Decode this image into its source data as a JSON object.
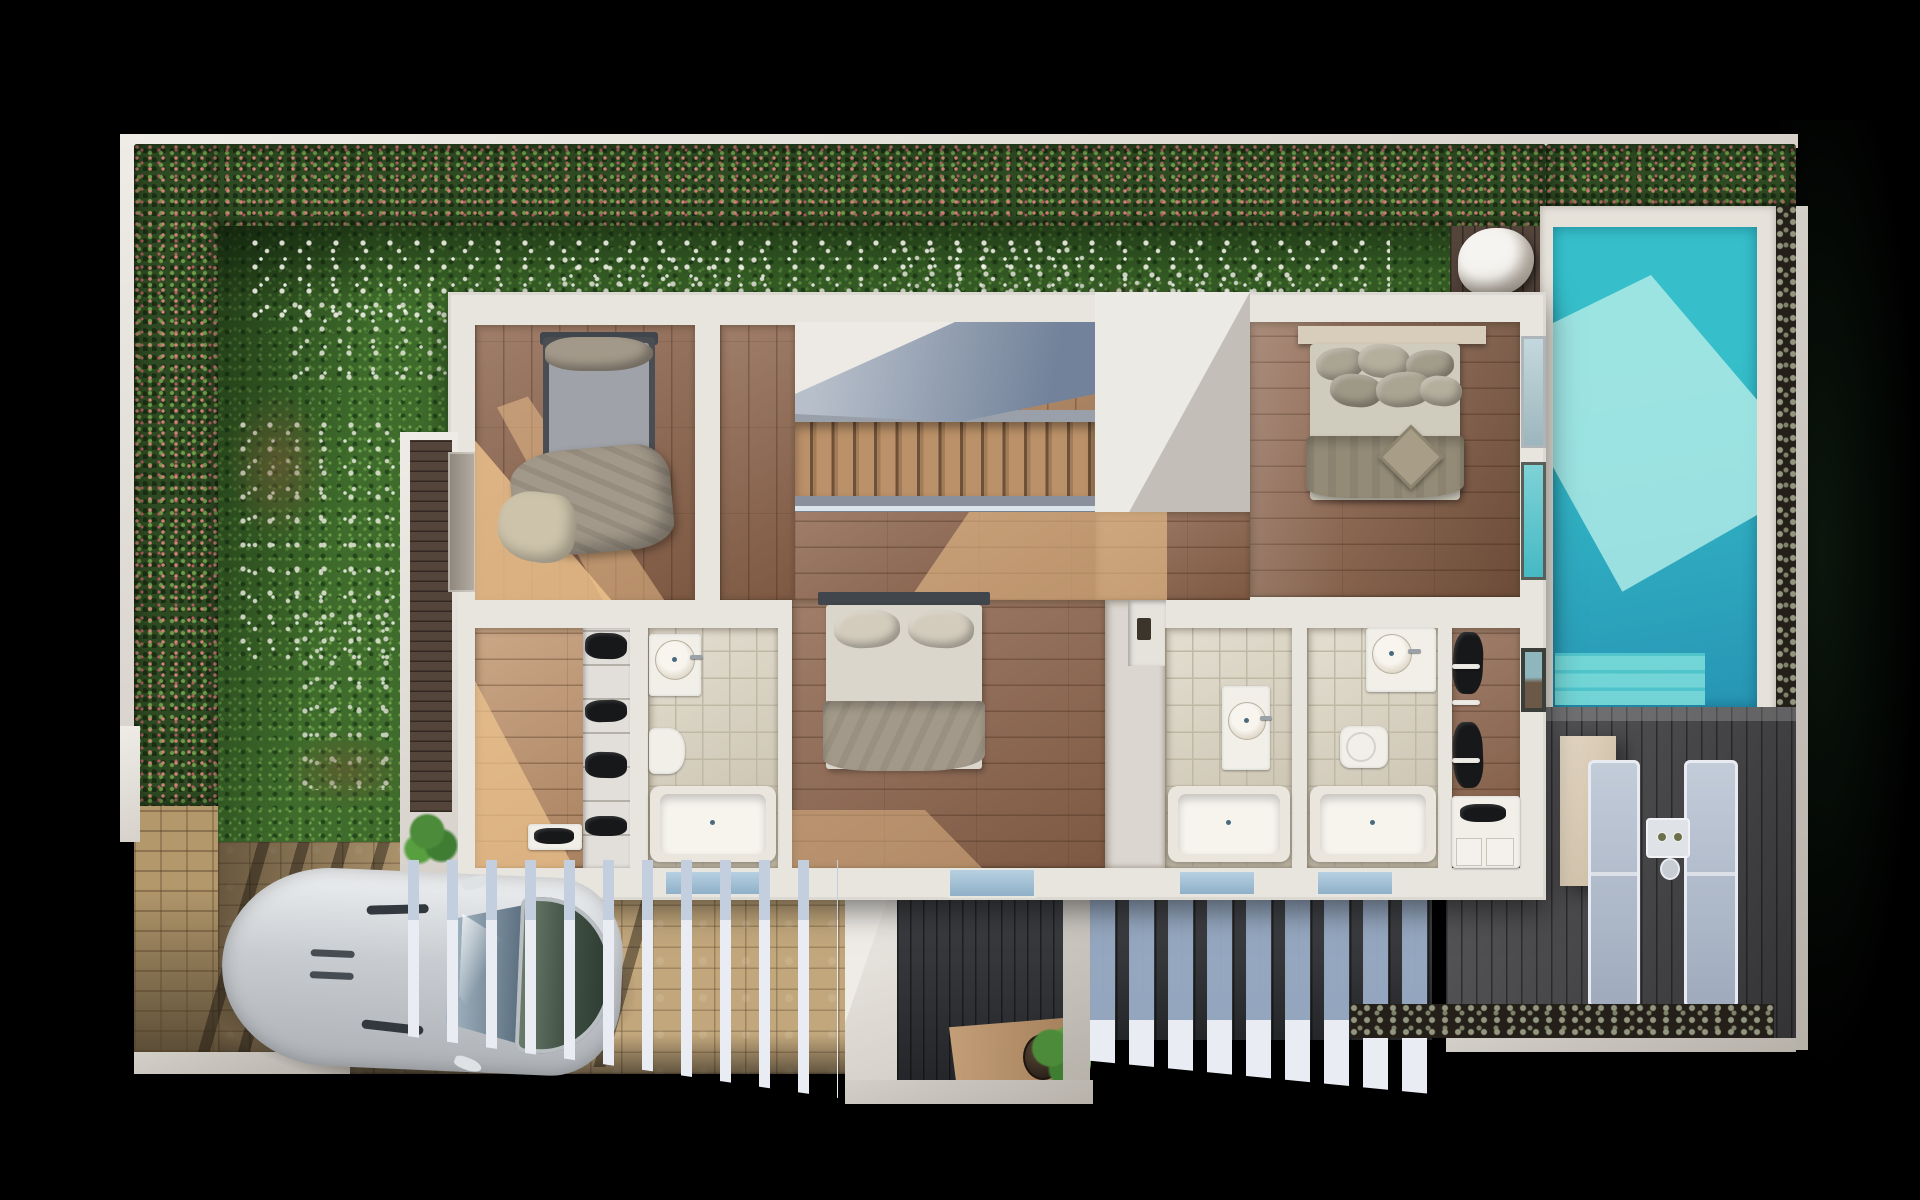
{
  "scene": {
    "title": "Top-down 3D render of a villa upper-floor plan",
    "view": "top-down axonometric cutaway",
    "rooms": [
      {
        "name": "bedroom-front",
        "label": "Front bedroom",
        "furniture": [
          "dark-frame bed with gray mattress",
          "taupe throw blankets",
          "door to side balcony"
        ]
      },
      {
        "name": "stair-hall",
        "label": "Staircase hall",
        "furniture": [
          "wood staircase",
          "glass railing",
          "gray canopy shade"
        ]
      },
      {
        "name": "master-bedroom",
        "label": "Master bedroom",
        "furniture": [
          "double bed with stacked pillows",
          "diamond accent cushion",
          "headboard shelf",
          "windows to pool"
        ]
      },
      {
        "name": "center-bedroom",
        "label": "Center bedroom",
        "furniture": [
          "double bed, two pillows, taupe foot blanket",
          "patio door"
        ]
      },
      {
        "name": "closet-left",
        "label": "Walk-in closet (left)",
        "furniture": [
          "wardrobe with shoe shelves",
          "bench with shoes"
        ]
      },
      {
        "name": "bathroom-left",
        "label": "Bathroom (left)",
        "furniture": [
          "vanity with round sink",
          "toilet",
          "bathtub"
        ]
      },
      {
        "name": "bathroom-middle",
        "label": "Bathroom (middle)",
        "furniture": [
          "vanity with round sink",
          "bathtub"
        ]
      },
      {
        "name": "bathroom-right",
        "label": "Bathroom (right)",
        "furniture": [
          "vanity with round sink",
          "toilet",
          "bathtub"
        ]
      },
      {
        "name": "closet-right",
        "label": "Walk-in closet (right)",
        "furniture": [
          "hanging clothes rails",
          "shoe shelves",
          "window to pool"
        ]
      }
    ],
    "outdoor": {
      "garden": {
        "label": "Lawn garden with daisies",
        "boundary": "flowering hedge on top and left walls"
      },
      "pool": {
        "label": "Swimming pool with entry steps",
        "water": "turquoise",
        "side_planting": "gray-green shrub border"
      },
      "pool_deck": {
        "label": "Dark timber pool deck",
        "loungers": 2,
        "side_table_cups": 2,
        "bean_bag": 1
      },
      "driveway": {
        "label": "Cobblestone driveway",
        "car": "silver sports car, top view"
      },
      "pergola_left_beams": 11,
      "pergola_right_beams": 9,
      "courtyard": {
        "label": "Entry courtyard, charcoal decking",
        "potted_plant": 1
      },
      "balcony": {
        "label": "Side balcony, dark decking",
        "potted_plant": 1
      }
    },
    "counts": {
      "bedrooms": 3,
      "bathrooms": 3,
      "closets": 2,
      "stair_treads": 14
    }
  },
  "colors": {
    "background": "#000000",
    "wallLight": "#e8e4de",
    "hedge": "#2e4a22",
    "hedgeFlowerPink": "#cf8277",
    "hedgeFlowerRed": "#b05c60",
    "hedgeLeaf": "#6f9c49",
    "hedgeDark": "#1b2e13",
    "grass": "#3f6c2c",
    "grassLight": "#5d9140",
    "grassDark": "#24471b",
    "daisy": "#f2f1e7",
    "oakLight": "#c39872",
    "oakMedium": "#8f6750",
    "oakSun": "#f2c globalization94",
    "tile": "#d9d2c0",
    "tileSeam": "#bfb8a5",
    "fixture": "#f2efe9",
    "poolWater": "#36bfca",
    "poolBright": "#aeeae6",
    "poolDeep": "#2795b5",
    "coping": "#e6e2da",
    "deckGray": "#49494c",
    "deckBrown": "#54453b",
    "charcoal": "#323438",
    "beamBlue": "#9db1cb",
    "beamWhite": "#e9edf3",
    "stone": "#c2a77c",
    "brick": "#b3986c",
    "carBody": "#d3d6d9",
    "headboard": "#41454c",
    "bedGray": "#9fa2a8",
    "bedBeige": "#cdc3ab",
    "bedWhite": "#dad6cb",
    "bedTaupe": "#a3998a",
    "masterPillow": "#aaa493",
    "masterMattress": "#cfccbe",
    "masterBlanket": "#948b77",
    "masterShelf": "#d8cdba",
    "clothes": "#17181a",
    "planter": "#4b8b39",
    "shrub": "#93977f",
    "soil": "#241f19",
    "oakSunFix": "#f0c48e"
  }
}
